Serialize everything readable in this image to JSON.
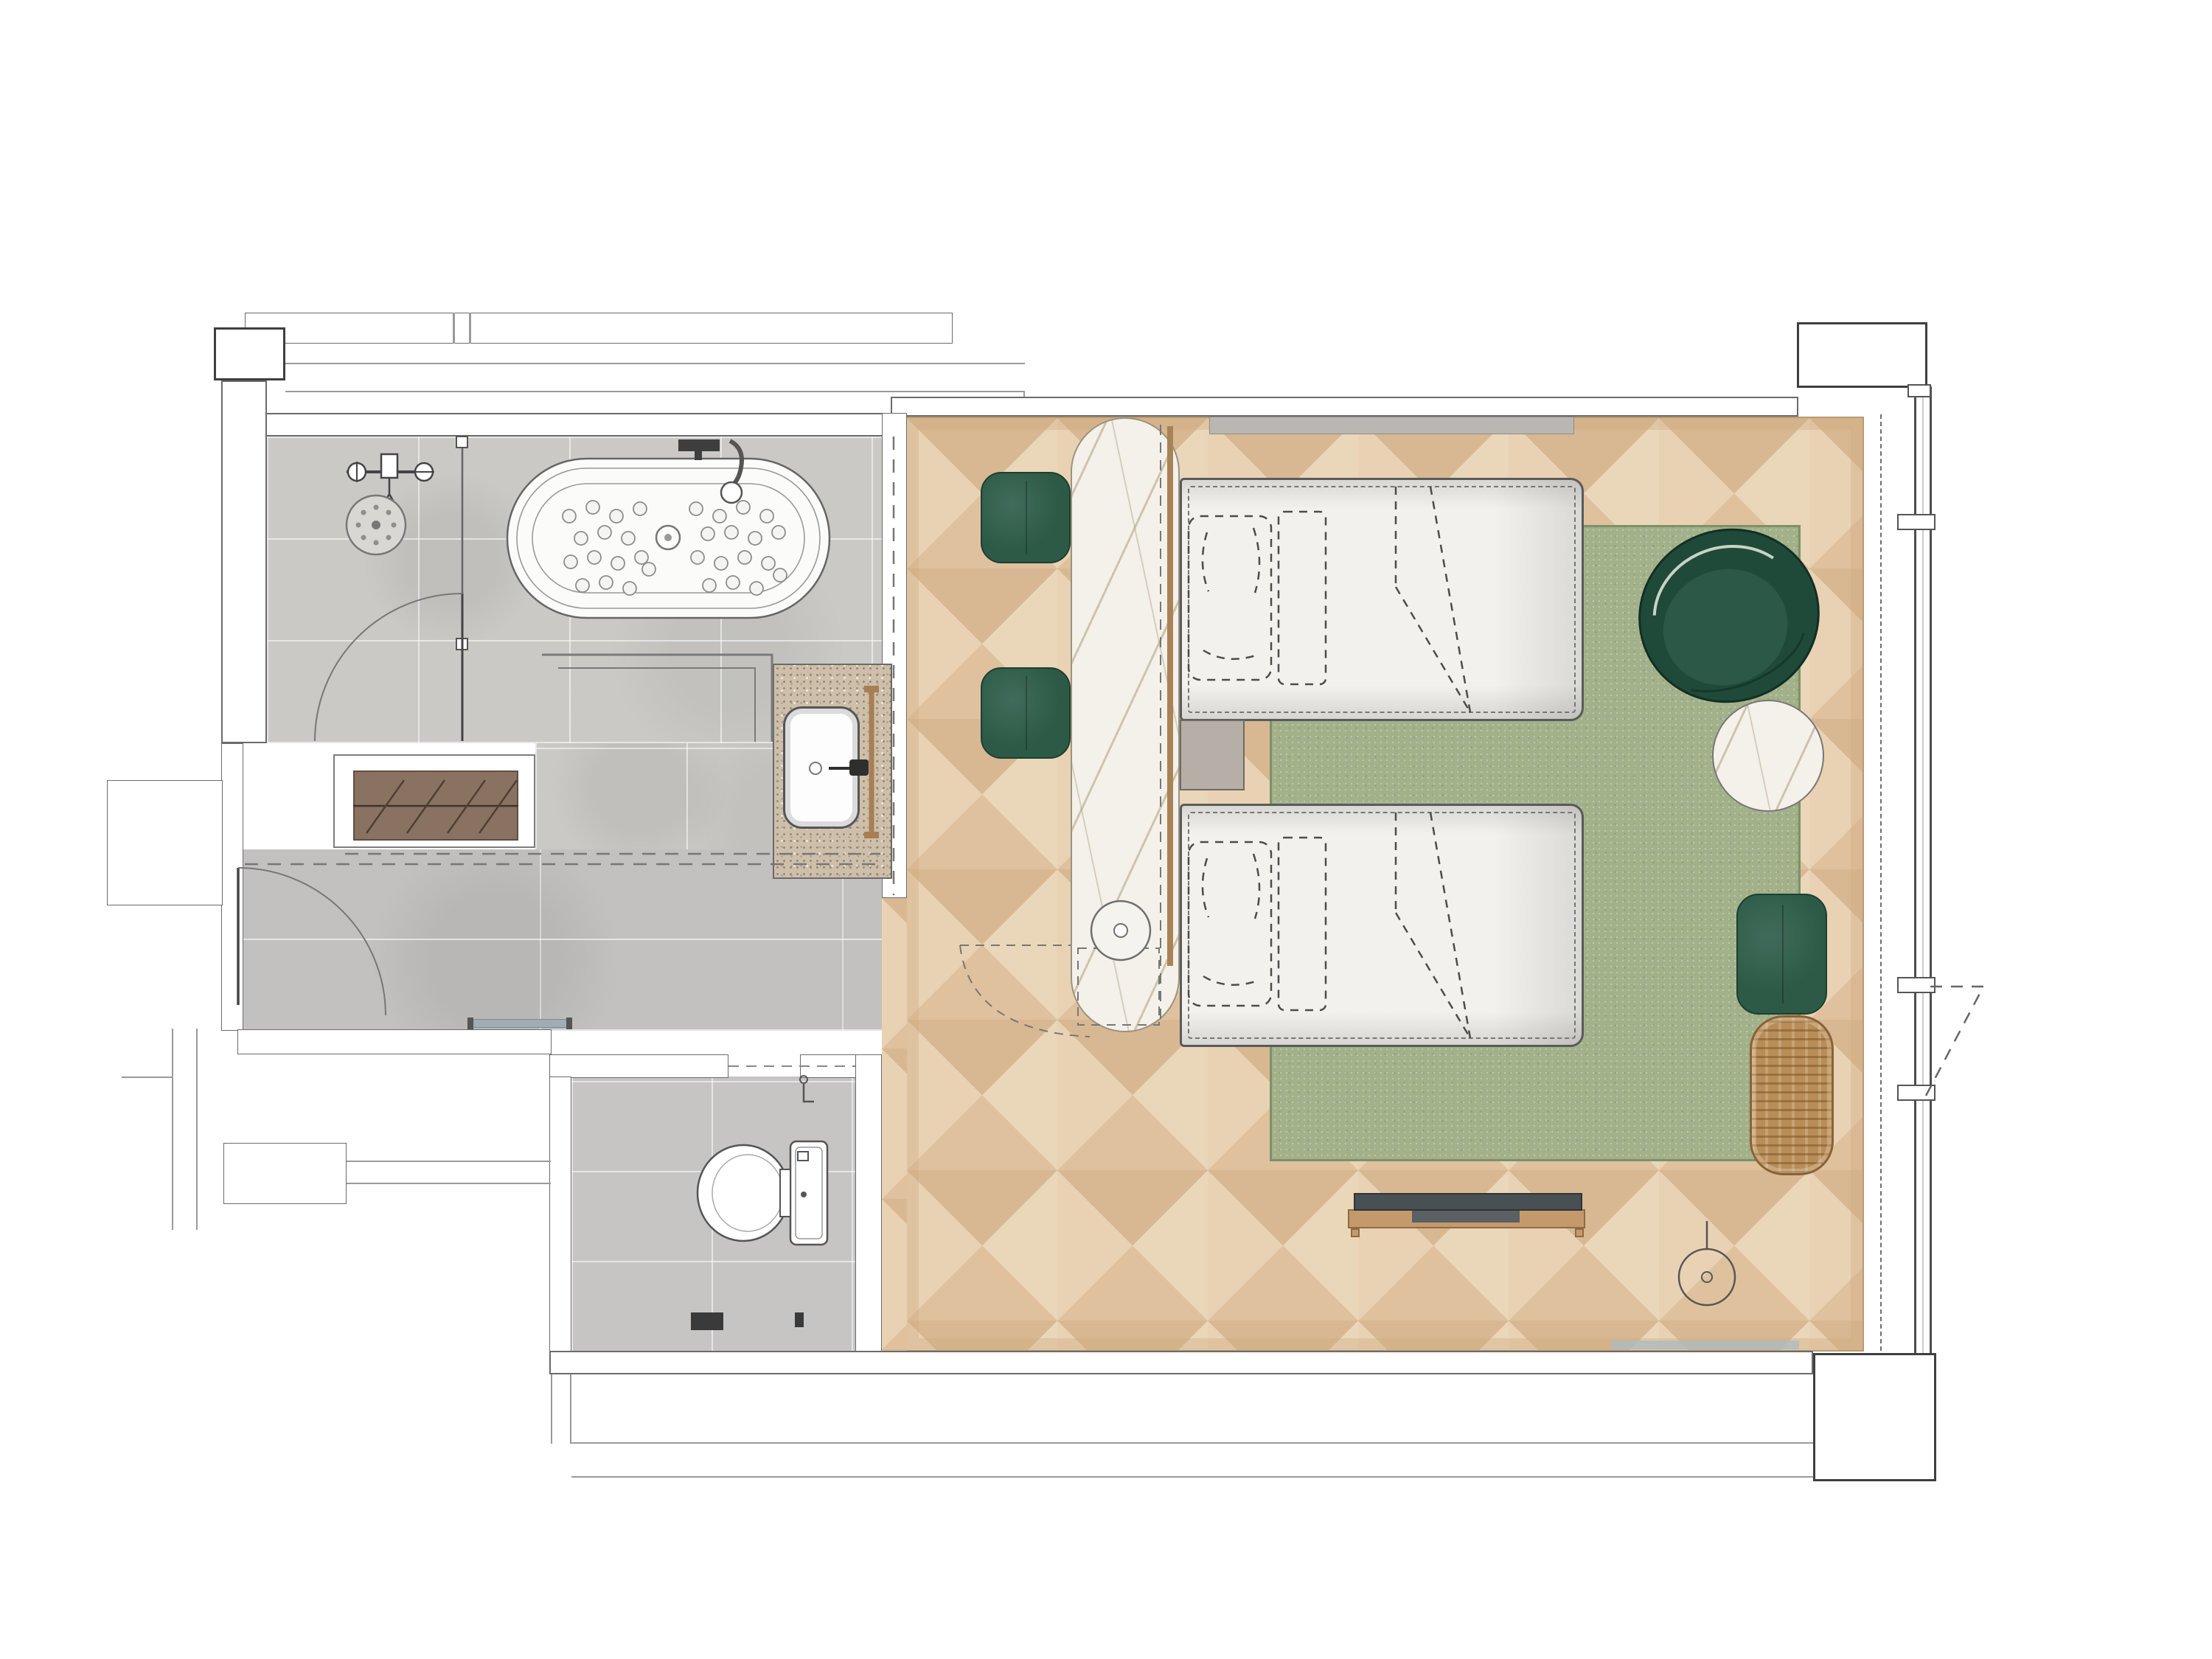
{
  "document": {
    "kind": "architectural-floor-plan",
    "view": "top-down-rendered-plan",
    "visible_text": [],
    "unit": "hotel-twin-guestroom-with-bathroom"
  },
  "palette": {
    "line": "#6b6b6b",
    "line_dark": "#3f3f3f",
    "line_soft": "#9a9a9a",
    "stone_tile": "#cac9c6",
    "plank_tile": "#c2c1bf",
    "toilet_tile": "#c6c5c3",
    "wood_a": "#ead6b9",
    "wood_b": "#dfc19e",
    "wood_c": "#e9d2b3",
    "wood_d": "#d8b893",
    "rug": "#a2b18a",
    "rug_edge": "#7f9069",
    "green": "#2c5a47",
    "green_dark": "#1f4a3a",
    "marble": "#f4f1ea",
    "granite": "#cdbfa9",
    "closet_wood": "#8a7262",
    "rattan": "#b98d56",
    "tv_dark": "#495054",
    "shelf_gray": "#bab7b2",
    "nightstand_gray": "#b5afa7",
    "threshold": "#9eadb6",
    "window_sill": "#aebbc2"
  },
  "rooms": [
    {
      "name": "bathroom",
      "label": "bathroom with freestanding bathtub and walk-in shower",
      "floor": "stone tile"
    },
    {
      "name": "vanity-area",
      "label": "vanity area with stone counter and sink",
      "floor": "stone tile"
    },
    {
      "name": "entry-corridor",
      "label": "entry corridor with wardrobe closet",
      "floor": "stone plank tile"
    },
    {
      "name": "toilet-room",
      "label": "separate toilet room",
      "floor": "stone tile"
    },
    {
      "name": "bedroom",
      "label": "twin bedroom with parquet floor, rug and window wall",
      "floor": "parquet wood"
    }
  ],
  "fixtures": [
    {
      "name": "shower-head",
      "label": "ceiling rain shower head"
    },
    {
      "name": "shower-valve",
      "label": "shower mixer valve"
    },
    {
      "name": "glass-partition",
      "label": "glass shower partition with swing door"
    },
    {
      "name": "bathtub",
      "label": "freestanding oval jetted bathtub"
    },
    {
      "name": "bathtub-faucet",
      "label": "deck mounted tub filler"
    },
    {
      "name": "vanity-counter",
      "label": "granite vanity counter"
    },
    {
      "name": "vanity-sink",
      "label": "undermount basin with faucet"
    },
    {
      "name": "towel-bar",
      "label": "wooden towel bar"
    },
    {
      "name": "wardrobe",
      "label": "open wardrobe with hanging rail"
    },
    {
      "name": "entry-door",
      "label": "entry door with swing arc"
    },
    {
      "name": "toilet",
      "label": "toilet with cistern"
    },
    {
      "name": "bed-1",
      "label": "twin bed with pillows and turned-down duvet"
    },
    {
      "name": "bed-2",
      "label": "twin bed with pillows and turned-down duvet"
    },
    {
      "name": "nightstand",
      "label": "bedside table between beds"
    },
    {
      "name": "headboard-shelf",
      "label": "wall mounted headboard ledge"
    },
    {
      "name": "marble-console",
      "label": "freestanding marble console desk"
    },
    {
      "name": "console-stool",
      "label": "round stool tucked under console"
    },
    {
      "name": "desk-stool-1",
      "label": "green upholstered stool"
    },
    {
      "name": "desk-stool-2",
      "label": "green upholstered stool"
    },
    {
      "name": "area-rug",
      "label": "sage green woven area rug"
    },
    {
      "name": "armchair",
      "label": "green barrel armchair"
    },
    {
      "name": "side-table",
      "label": "round marble side table"
    },
    {
      "name": "ottoman",
      "label": "green ottoman bench"
    },
    {
      "name": "rattan-bench",
      "label": "rattan bench"
    },
    {
      "name": "tv-console",
      "label": "media console with television"
    },
    {
      "name": "floor-lamp",
      "label": "arc floor lamp"
    },
    {
      "name": "window-wall",
      "label": "floor to ceiling glazing with outward opening vent"
    },
    {
      "name": "curtain-line",
      "label": "curtain track dashed line"
    }
  ]
}
